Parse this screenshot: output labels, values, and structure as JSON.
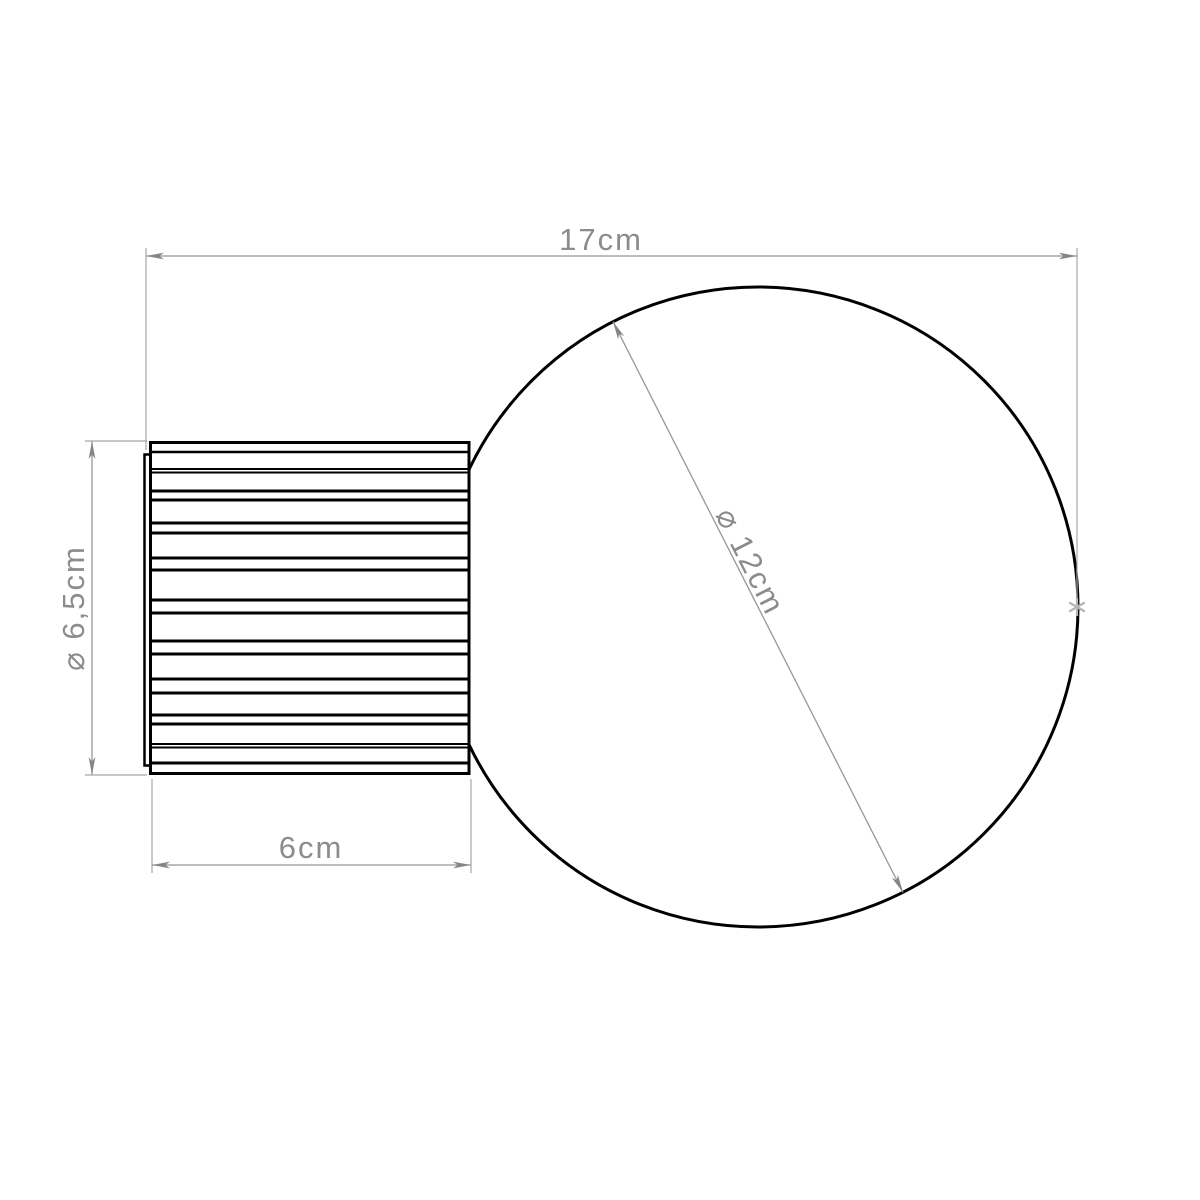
{
  "drawing": {
    "dimensions": {
      "overall_width": "17cm",
      "base_diameter": "⌀ 6,5cm",
      "base_length": "6cm",
      "globe_diameter": "⌀ 12cm"
    },
    "colors": {
      "outline": "#000000",
      "dimension_line": "#979797",
      "dimension_text": "#8c8c8c",
      "tangent_marker": "#b5b5b5"
    }
  }
}
